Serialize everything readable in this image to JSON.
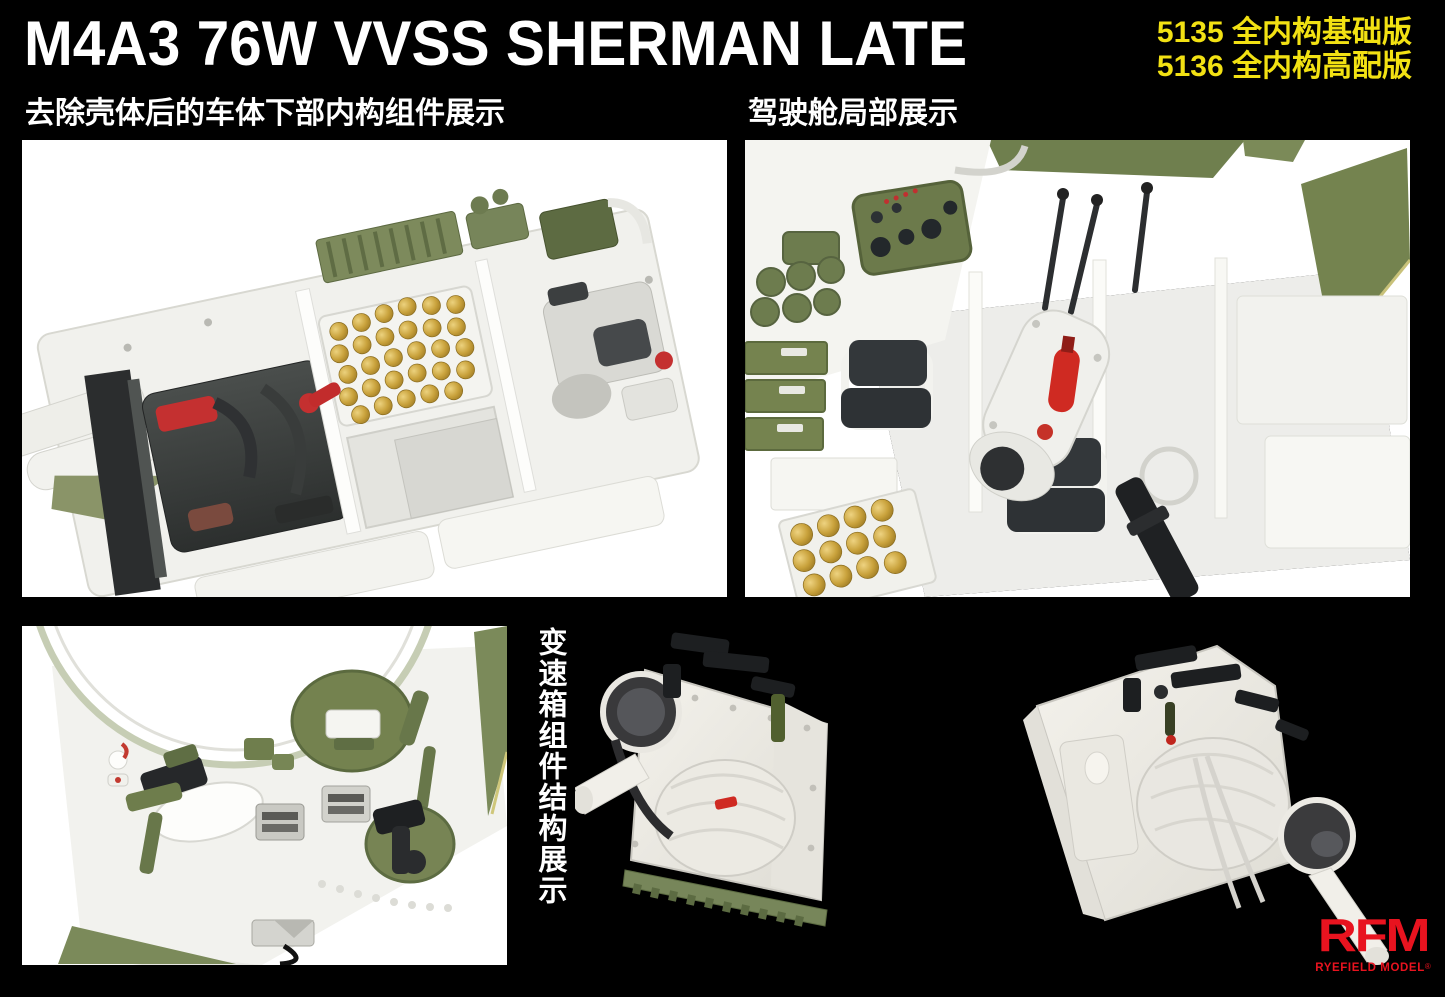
{
  "title": "M4A3 76W VVSS SHERMAN LATE",
  "product_codes": {
    "line1": "5135 全内构基础版",
    "line2": "5136 全内构高配版"
  },
  "captions": {
    "hull_lower": "去除壳体后的车体下部内构组件展示",
    "driver_compartment": "驾驶舱局部展示",
    "transmission": "变速箱组件结构展示"
  },
  "renders": {
    "hull_lower": "lower-hull-interior-cutaway-render",
    "driver_compartment": "driver-compartment-interior-render",
    "upper_hull": "upper-hull-underside-hatch-render",
    "transmission_left": "transmission-assembly-front-left-view",
    "transmission_right": "transmission-assembly-rear-right-view"
  },
  "logo": {
    "abbr": "RFM",
    "name": "RYEFIELD MODEL",
    "registered": "®"
  },
  "colors": {
    "background": "#000000",
    "title_text": "#ffffff",
    "accent_yellow": "#f2e113",
    "logo_red": "#e8131f",
    "olive_green": "#75824f",
    "brass_gold": "#c9a23c",
    "panel_white": "#ffffff"
  }
}
